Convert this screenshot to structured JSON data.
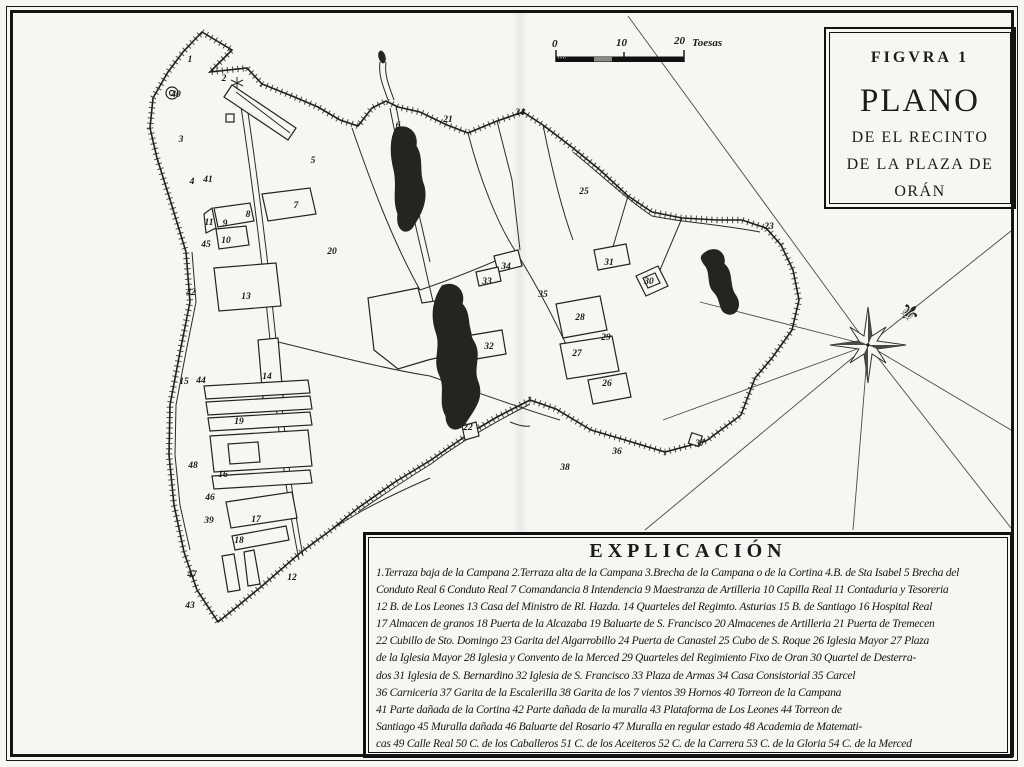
{
  "title_box": {
    "figura_label": "FIGVRA 1",
    "title": "PLANO",
    "subtitle1": "DE EL RECINTO",
    "subtitle2": "DE LA PLAZA DE",
    "subtitle3": "ORÁN"
  },
  "scale_bar": {
    "tick_0": "0",
    "tick_10": "10",
    "tick_20": "20",
    "unit_label": "Toesas"
  },
  "legend": {
    "title": "EXPLICACIÓN",
    "lines": [
      "1.Terraza baja de la Campana 2.Terraza alta de la Campana 3.Brecha de la Campana o de la Cortina 4.B. de Sta Isabel 5 Brecha del",
      "Conduto Real 6 Conduto Real 7 Comandancia 8 Intendencia 9 Maestranza de Artilleria 10 Capilla Real 11 Contaduria y Tesoreria",
      "12 B. de Los Leones 13 Casa del Ministro de Rl. Hazda. 14 Quarteles del Regimto. Asturias 15 B. de Santiago 16 Hospital Real",
      "17 Almacen de granos 18 Puerta de la Alcazaba 19 Baluarte de S. Francisco 20 Almacenes de Artilleria 21 Puerta de Tremecen",
      "22 Cubillo de Sto. Domingo 23 Garita del Algarrobillo 24 Puerta de Canastel 25 Cubo de S. Roque 26 Iglesia Mayor 27 Plaza",
      "de la Iglesia Mayor 28 Iglesia y Convento de la Merced 29 Quarteles del Regimiento Fixo de Oran 30 Quartel de Desterra-",
      "dos 31 Iglesia de S. Bernardino 32 Iglesia de S. Francisco 33 Plaza de Armas 34 Casa Consistorial 35 Carcel",
      "36 Carniceria 37 Garita de la Escalerilla 38 Garita de los 7 vientos 39 Hornos 40 Torreon de la Campana",
      "41 Parte dañada de la Cortina 42 Parte dañada de la muralla 43 Plataforma de Los Leones 44 Torreon de",
      "Santiago 45 Muralla dañada 46 Baluarte del Rosario 47 Muralla en regular estado 48 Academia de Matemati-",
      "cas 49 Calle Real 50 C. de los Caballeros 51 C. de los Aceiteros 52 C. de la Carrera 53 C. de la Gloria 54 C. de la Merced"
    ]
  },
  "compass": {
    "fleur_de_lis_glyph": "⚜"
  },
  "map": {
    "numbers": [
      {
        "n": "1",
        "x": 190,
        "y": 60
      },
      {
        "n": "2",
        "x": 224,
        "y": 79
      },
      {
        "n": "40",
        "x": 176,
        "y": 95
      },
      {
        "n": "3",
        "x": 181,
        "y": 140
      },
      {
        "n": "4",
        "x": 192,
        "y": 182
      },
      {
        "n": "41",
        "x": 208,
        "y": 180
      },
      {
        "n": "5",
        "x": 313,
        "y": 161
      },
      {
        "n": "6",
        "x": 398,
        "y": 126
      },
      {
        "n": "7",
        "x": 296,
        "y": 206
      },
      {
        "n": "8",
        "x": 248,
        "y": 215
      },
      {
        "n": "9",
        "x": 225,
        "y": 224
      },
      {
        "n": "11",
        "x": 209,
        "y": 223
      },
      {
        "n": "10",
        "x": 226,
        "y": 241
      },
      {
        "n": "45",
        "x": 206,
        "y": 245
      },
      {
        "n": "42",
        "x": 191,
        "y": 293
      },
      {
        "n": "13",
        "x": 246,
        "y": 297
      },
      {
        "n": "20",
        "x": 332,
        "y": 252
      },
      {
        "n": "21",
        "x": 448,
        "y": 120
      },
      {
        "n": "24",
        "x": 520,
        "y": 113
      },
      {
        "n": "25",
        "x": 584,
        "y": 192
      },
      {
        "n": "23",
        "x": 769,
        "y": 227
      },
      {
        "n": "31",
        "x": 609,
        "y": 263
      },
      {
        "n": "30",
        "x": 649,
        "y": 282
      },
      {
        "n": "34",
        "x": 506,
        "y": 267
      },
      {
        "n": "33",
        "x": 487,
        "y": 282
      },
      {
        "n": "35",
        "x": 543,
        "y": 295
      },
      {
        "n": "28",
        "x": 580,
        "y": 318
      },
      {
        "n": "29",
        "x": 606,
        "y": 338
      },
      {
        "n": "27",
        "x": 577,
        "y": 354
      },
      {
        "n": "26",
        "x": 607,
        "y": 384
      },
      {
        "n": "32",
        "x": 489,
        "y": 347
      },
      {
        "n": "36",
        "x": 617,
        "y": 452
      },
      {
        "n": "37",
        "x": 700,
        "y": 444
      },
      {
        "n": "22",
        "x": 468,
        "y": 428
      },
      {
        "n": "38",
        "x": 565,
        "y": 468
      },
      {
        "n": "14",
        "x": 267,
        "y": 377
      },
      {
        "n": "15",
        "x": 184,
        "y": 382
      },
      {
        "n": "44",
        "x": 201,
        "y": 381
      },
      {
        "n": "19",
        "x": 239,
        "y": 422
      },
      {
        "n": "16",
        "x": 223,
        "y": 475
      },
      {
        "n": "48",
        "x": 193,
        "y": 466
      },
      {
        "n": "39",
        "x": 209,
        "y": 521
      },
      {
        "n": "17",
        "x": 256,
        "y": 520
      },
      {
        "n": "18",
        "x": 239,
        "y": 541
      },
      {
        "n": "47",
        "x": 192,
        "y": 575
      },
      {
        "n": "46",
        "x": 210,
        "y": 498
      },
      {
        "n": "43",
        "x": 190,
        "y": 606
      },
      {
        "n": "12",
        "x": 292,
        "y": 578
      }
    ]
  }
}
